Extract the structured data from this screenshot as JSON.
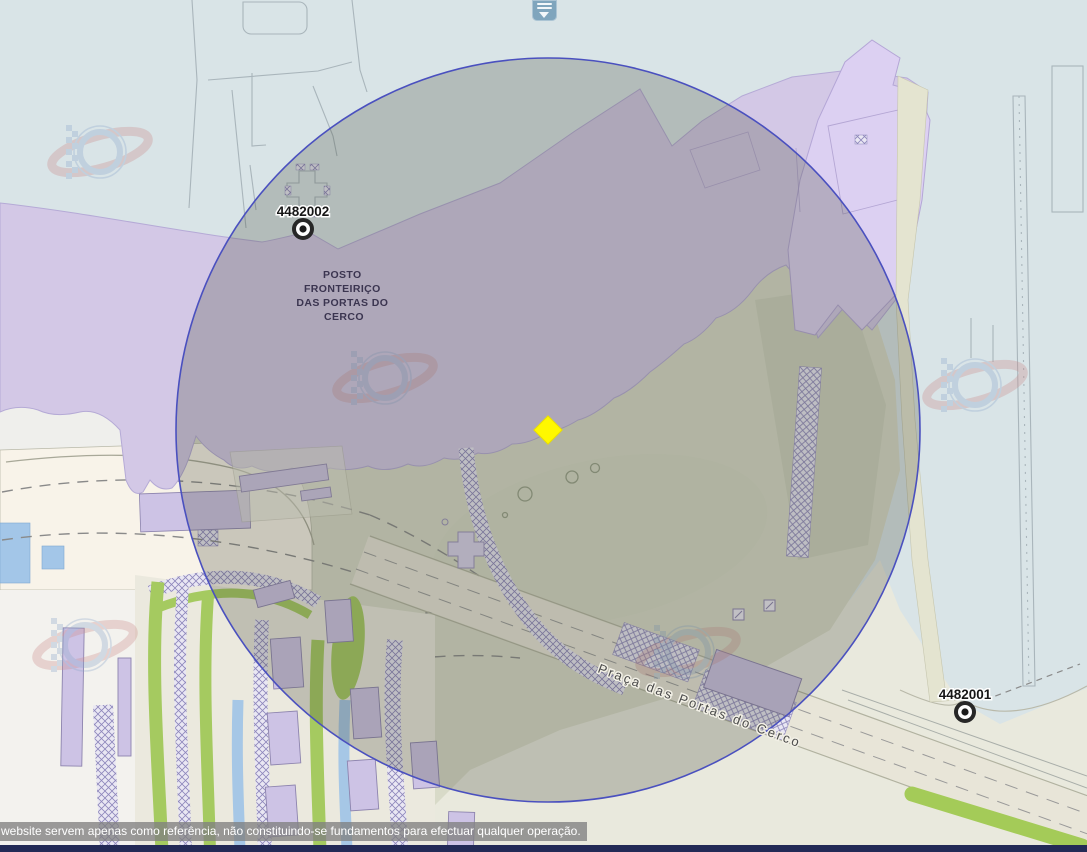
{
  "map": {
    "markers": [
      {
        "id": "4482002"
      },
      {
        "id": "4482001"
      }
    ],
    "border_post_label_lines": [
      "POSTO",
      "FRONTEIRIÇO",
      "DAS PORTAS DO",
      "CERCO"
    ],
    "street_label": "Praça das Portas do Cerco",
    "colors": {
      "selected_marker": "#fff800",
      "buffer_circle_border": "#4a50bf",
      "buffer_circle_fill": "rgba(70,75,58,0.26)",
      "water": "#d9e4e7",
      "border_zone": "#d3c8e6"
    },
    "icons": {
      "station_marker": "bullseye-icon",
      "selected_point": "yellow-diamond-icon",
      "watermark": "dscc-logo-watermark",
      "drawer_handle": "drawer-collapse-icon"
    }
  },
  "footer": {
    "disclaimer": "website servem apenas como referência, não constituindo-se fundamentos para efectuar qualquer operação."
  }
}
